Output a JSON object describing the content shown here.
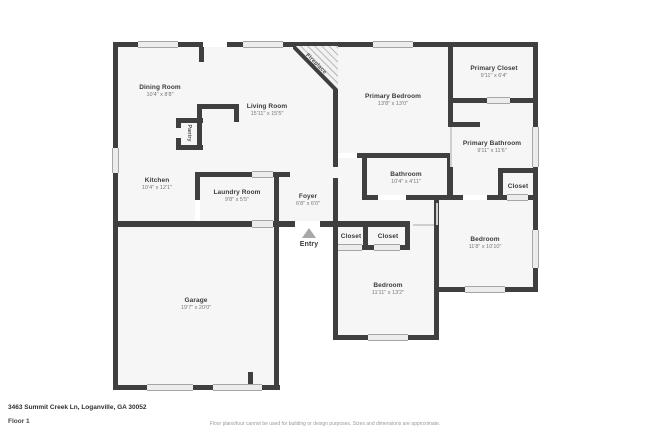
{
  "rooms": {
    "dining": {
      "name": "Dining Room",
      "dims": "10'4\" x 8'8\""
    },
    "living": {
      "name": "Living Room",
      "dims": "15'11\" x 15'5\""
    },
    "kitchen": {
      "name": "Kitchen",
      "dims": "10'4\" x 12'1\""
    },
    "laundry": {
      "name": "Laundry Room",
      "dims": "9'8\" x 5'5\""
    },
    "foyer": {
      "name": "Foyer",
      "dims": "6'8\" x 6'0\""
    },
    "garage": {
      "name": "Garage",
      "dims": "19'7\" x 20'0\""
    },
    "primary_bedroom": {
      "name": "Primary Bedroom",
      "dims": "13'8\" x 13'0\""
    },
    "primary_closet": {
      "name": "Primary Closet",
      "dims": "9'11\" x 6'4\""
    },
    "primary_bathroom": {
      "name": "Primary Bathroom",
      "dims": "9'11\" x 11'6\""
    },
    "bathroom": {
      "name": "Bathroom",
      "dims": "10'4\" x 4'11\""
    },
    "bedroom_middle": {
      "name": "Bedroom",
      "dims": "11'11\" x 13'2\""
    },
    "bedroom_right": {
      "name": "Bedroom",
      "dims": "11'8\" x 10'10\""
    },
    "closet_hall_1": {
      "name": "Closet"
    },
    "closet_hall_2": {
      "name": "Closet"
    },
    "closet_bedroom": {
      "name": "Closet"
    },
    "pantry": {
      "name": "Pantry"
    }
  },
  "annotations": {
    "entry": "Entry",
    "fireplace": "Fireplace"
  },
  "footer": {
    "address": "3463 Summit Creek Ln, Loganville, GA 30052",
    "floor": "Floor 1",
    "disclaimer": "Floor plans/tour cannot be used for building or design purposes. Sizes and dimensions are approximate."
  },
  "colors": {
    "wall": "#3f3f3f",
    "room_fill": "#f6f6f6",
    "window_fill": "#ececec",
    "entry_arrow": "#a8a8a8",
    "room_title_text": "#3b3b3b",
    "dims_text": "#787878",
    "disclaimer_text": "#999999"
  }
}
